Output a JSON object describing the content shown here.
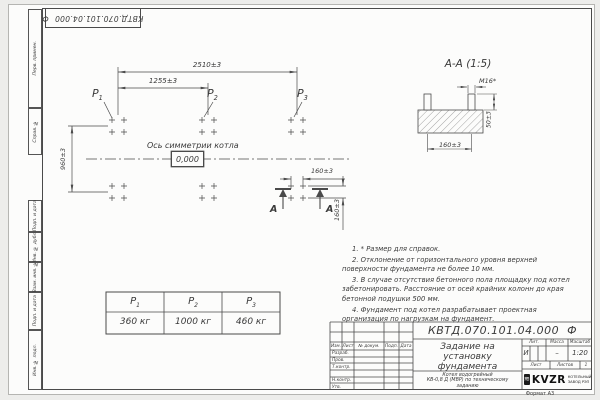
{
  "doc": {
    "number": "КВТД.070.101.04.000",
    "suffix": "Ф"
  },
  "frame_labels": [
    "Перв. примен.",
    "Справ. №",
    "Подп. и дата",
    "Инв. № дубл.",
    "Взам. инв. №",
    "Подп. и дата",
    "Инв. № подл."
  ],
  "plan": {
    "dim_overall": "2510±3",
    "dim_half": "1255±3",
    "dim_depth": "960±3",
    "dim_bolt_h": "160±3",
    "dim_bolt_v": "160±3",
    "axis_label": "Ось симметрии котла",
    "level_mark": "0,000",
    "section_letter_1": "А",
    "section_letter_2": "А",
    "loads": [
      {
        "base": "Р",
        "sub": "1"
      },
      {
        "base": "Р",
        "sub": "2"
      },
      {
        "base": "Р",
        "sub": "3"
      }
    ]
  },
  "section": {
    "title": "А-А (1:5)",
    "dim_thread": "М16*",
    "dim_height": "50±3",
    "dim_spacing": "160±3"
  },
  "notes": [
    "1. * Размер для справок.",
    "2. Отклонение от горизонтального уровня верхней поверхности фундамента не более 10 мм.",
    "3. В случае отсутствия бетонного пола площадку под котел забетонировать. Расстояние от осей крайних колонн до края бетонной подушки 500 мм.",
    "4. Фундамент под котел разрабатывает проектная организация по нагрузкам на фундамент."
  ],
  "load_table": {
    "headers": [
      {
        "base": "Р",
        "sub": "1"
      },
      {
        "base": "Р",
        "sub": "2"
      },
      {
        "base": "Р",
        "sub": "3"
      }
    ],
    "values": [
      "360 кг",
      "1000 кг",
      "460 кг"
    ]
  },
  "title_block": {
    "revision_cols": [
      "Изм.",
      "Лист",
      "№ докум.",
      "Подп.",
      "Дата"
    ],
    "signature_rows": [
      "Разраб.",
      "Пров.",
      "Т.контр.",
      "",
      "Н.контр.",
      "Утв."
    ],
    "title": "Задание на установку фундамента",
    "subtitle_line1": "Котел водогрейный",
    "subtitle_line2": "КВ-0,8 Д (МВР) по техническому",
    "subtitle_line3": "заданию",
    "lit_label": "Лит.",
    "lit_value": "И",
    "mass_label": "Масса",
    "mass_value": "–",
    "scale_label": "Масштаб",
    "scale_value": "1:20",
    "sheet_label": "Лист",
    "sheets_label": "Листов",
    "sheets_value": "1",
    "logo_text": "KVZR",
    "logo_caption_line1": "КОТЕЛЬНЫЙ",
    "logo_caption_line2": "ЗАВОД РЭП",
    "format_label": "Формат А3"
  }
}
